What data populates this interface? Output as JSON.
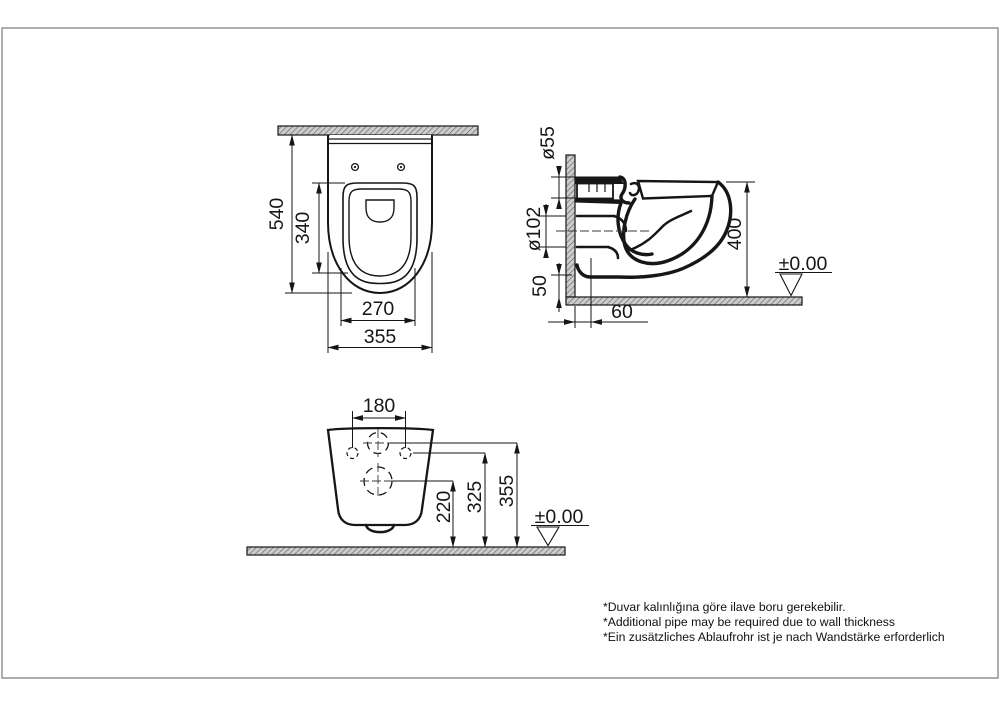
{
  "drawing": {
    "top_view": {
      "overall_depth": "540",
      "seat_depth": "340",
      "seat_width": "270",
      "overall_width": "355"
    },
    "side_view": {
      "inlet_diameter": "ø55",
      "outlet_diameter": "ø102",
      "bottom_gap": "50",
      "overall_height": "400",
      "outlet_offset": "60",
      "floor_datum": "±0.00"
    },
    "rear_view": {
      "bolt_spacing": "180",
      "outlet_height": "220",
      "bolt_height": "325",
      "inlet_height": "355",
      "floor_datum": "±0.00"
    },
    "footnotes": [
      "*Duvar kalınlığına göre ilave boru gerekebilir.",
      "*Additional pipe may be required due to wall thickness",
      "*Ein zusätzliches Ablaufrohr ist je nach Wandstärke erforderlich"
    ],
    "colors": {
      "line": "#161616",
      "hatch_fill": "#cccccc",
      "frame": "#9a9a9a"
    }
  }
}
